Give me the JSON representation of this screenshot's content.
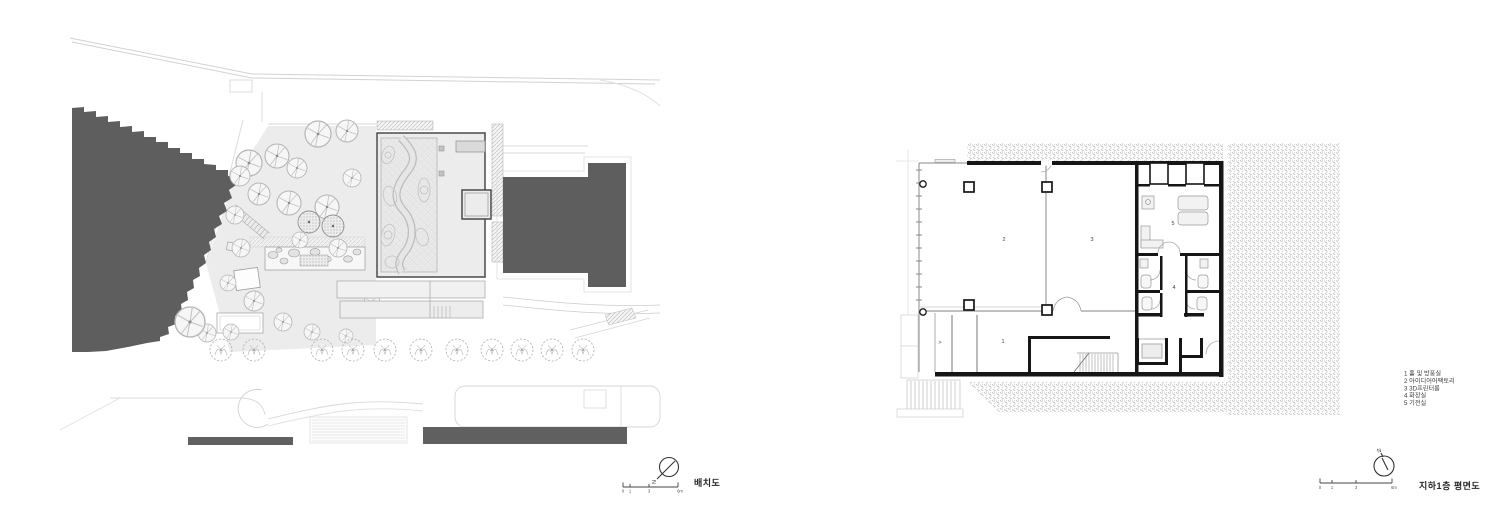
{
  "site_plan": {
    "title": "배치도",
    "north_label": "N",
    "scale_labels": [
      "0",
      "1",
      "3",
      "6m"
    ]
  },
  "floor_plan": {
    "title": "지하1층 평면도",
    "north_label": "N",
    "scale_labels": [
      "0",
      "1",
      "3",
      "6m"
    ],
    "rooms": [
      "1",
      "2",
      "3",
      "4",
      "5"
    ],
    "door_mark": ">",
    "legend": [
      "1 홀 및 방풍실",
      "2 아이디어어팩토리",
      "3 3D프린터룸",
      "4 화장실",
      "5 기전실"
    ]
  },
  "colors": {
    "building_mass": "#5e5e5e",
    "road_bar": "#606060",
    "wall": "#161616",
    "ground": "#ececec",
    "line_light": "#cccccc"
  }
}
